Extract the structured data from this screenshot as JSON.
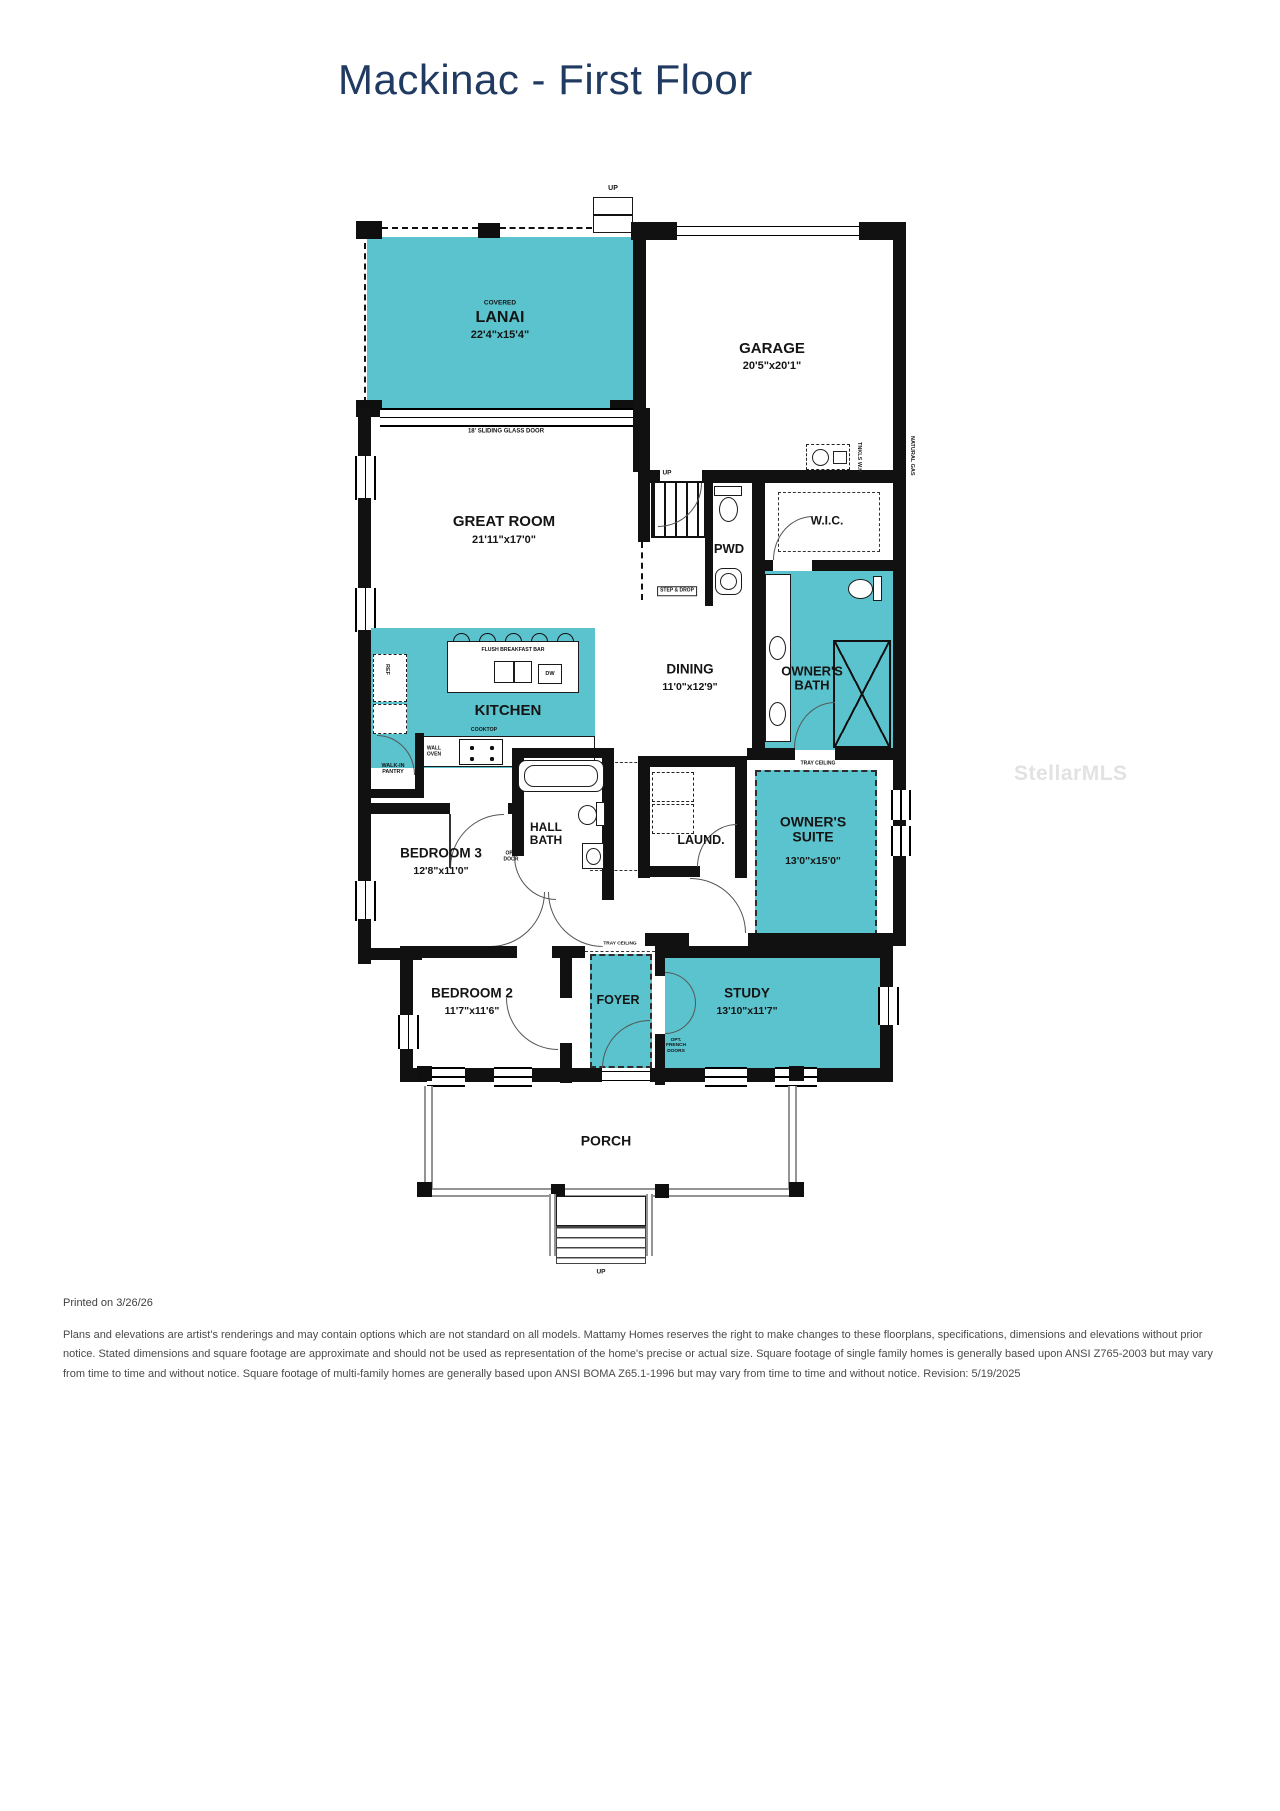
{
  "title": "Mackinac - First Floor",
  "watermark": "StellarMLS",
  "colors": {
    "accent": "#5bc3cd",
    "walls": "#111111",
    "title": "#203a61"
  },
  "rooms": {
    "lanai": {
      "prefix": "COVERED",
      "name": "LANAI",
      "dims": "22'4\"x15'4\""
    },
    "garage": {
      "name": "GARAGE",
      "dims": "20'5\"x20'1\""
    },
    "great_room": {
      "name": "GREAT ROOM",
      "dims": "21'11\"x17'0\""
    },
    "pwd": {
      "name": "PWD"
    },
    "wic": {
      "name": "W.I.C."
    },
    "dining": {
      "name": "DINING",
      "dims": "11'0\"x12'9\""
    },
    "owners_bath": {
      "name": "OWNER'S BATH"
    },
    "kitchen": {
      "name": "KITCHEN"
    },
    "owners_suite": {
      "name": "OWNER'S SUITE",
      "dims": "13'0\"x15'0\""
    },
    "bedroom3": {
      "name": "BEDROOM 3",
      "dims": "12'8\"x11'0\""
    },
    "hall_bath": {
      "name": "HALL BATH"
    },
    "laundry": {
      "name": "LAUND."
    },
    "bedroom2": {
      "name": "BEDROOM 2",
      "dims": "11'7\"x11'6\""
    },
    "foyer": {
      "name": "FOYER"
    },
    "study": {
      "name": "STUDY",
      "dims": "13'10\"x11'7\""
    },
    "porch": {
      "name": "PORCH"
    }
  },
  "annotations": {
    "up": "UP",
    "sliding_door": "18' SLIDING GLASS DOOR",
    "breakfast_bar": "FLUSH BREAKFAST BAR",
    "cooktop": "COOKTOP",
    "wall_oven": "WALL OVEN",
    "walk_in_pantry": "WALK-IN PANTRY",
    "step_and_drop": "STEP & DROP",
    "tray_ceiling": "TRAY CEILING",
    "opt_door": "OPT. DOOR",
    "opt_french_doors": "OPT. FRENCH DOORS",
    "dw": "DW",
    "ref": "REF",
    "tankless_wh": "TNKLS W.H.",
    "natural_gas": "NATURAL GAS"
  },
  "footer": {
    "printed_on": "Printed on 3/26/26",
    "disclaimer": "Plans and elevations are artist's renderings and may contain options which are not standard on all models. Mattamy Homes reserves the right to make changes to these floorplans, specifications, dimensions and elevations without prior notice. Stated dimensions and square footage are approximate and should not be used as representation of the home's precise or actual size. Square footage of single family homes is generally based upon ANSI Z765-2003 but may vary from time to time and without notice. Square footage of multi-family homes are generally based upon ANSI BOMA Z65.1-1996 but may vary from time to time and without notice. Revision: 5/19/2025"
  }
}
